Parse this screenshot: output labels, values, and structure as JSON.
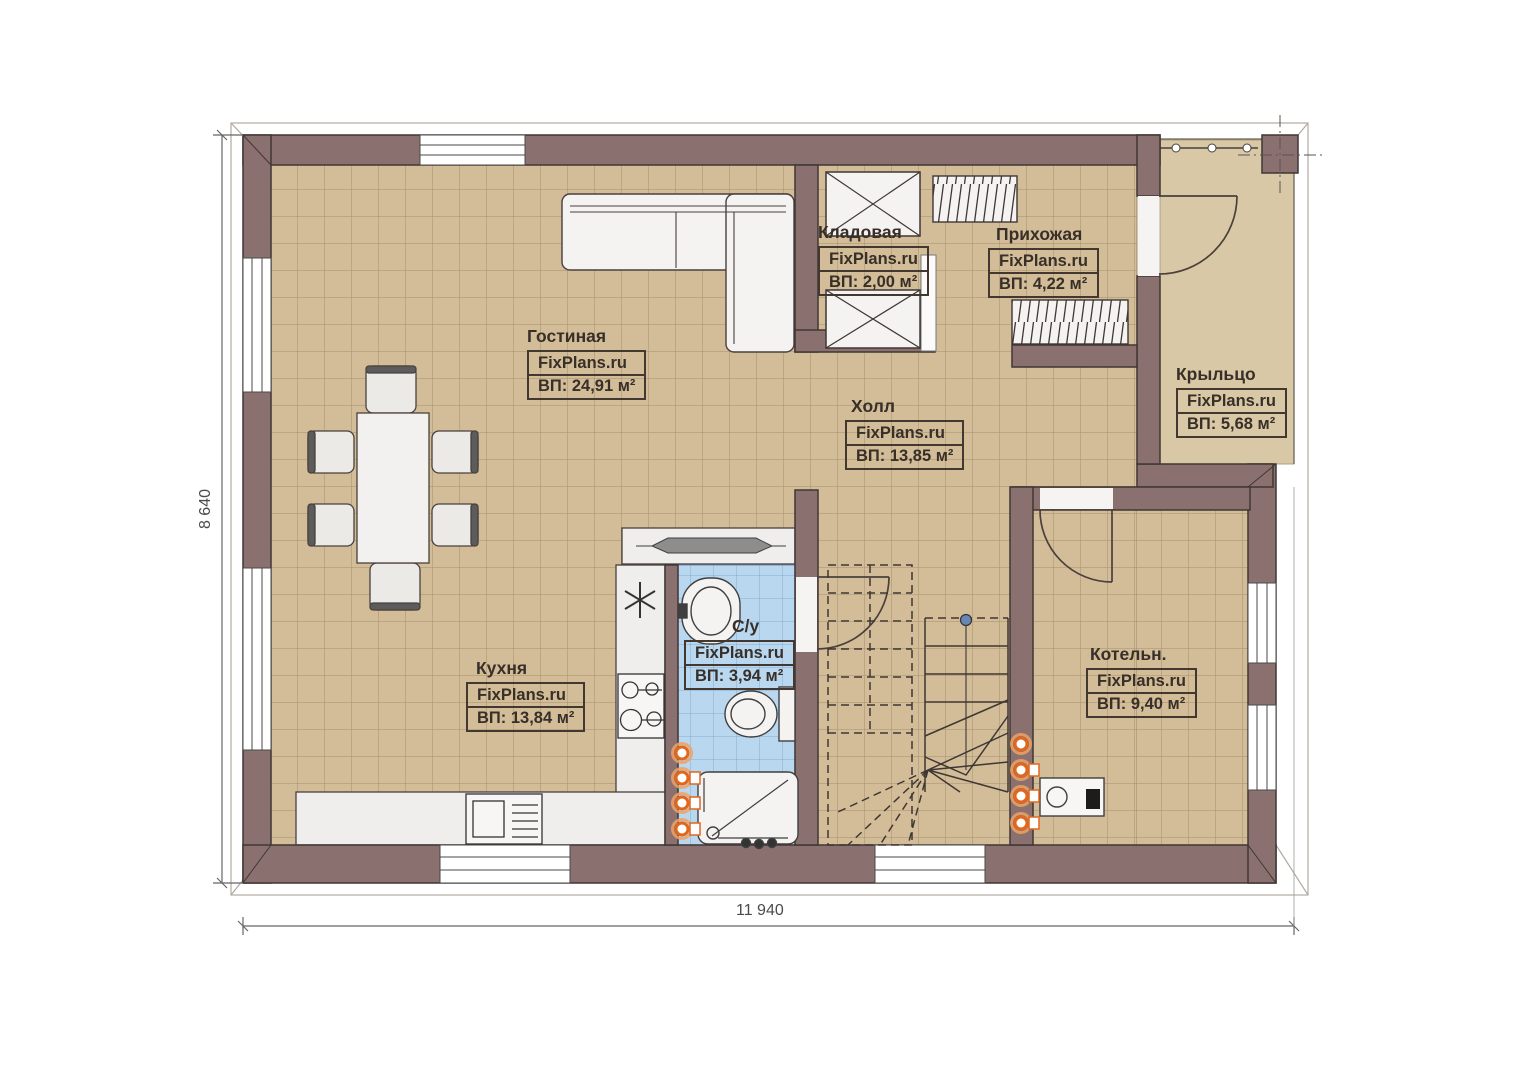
{
  "plan": {
    "title": "Floor plan first floor",
    "brand": "FixPlans.ru",
    "rooms": [
      {
        "name": "Гостиная",
        "brand": "FixPlans.ru",
        "area": "ВП: 24,91 м²"
      },
      {
        "name": "Кладовая",
        "brand": "FixPlans.ru",
        "area": "ВП: 2,00 м²"
      },
      {
        "name": "Прихожая",
        "brand": "FixPlans.ru",
        "area": "ВП: 4,22 м²"
      },
      {
        "name": "Крыльцо",
        "brand": "FixPlans.ru",
        "area": "ВП: 5,68 м²"
      },
      {
        "name": "Холл",
        "brand": "FixPlans.ru",
        "area": "ВП: 13,85 м²"
      },
      {
        "name": "Кухня",
        "brand": "FixPlans.ru",
        "area": "ВП: 13,84 м²"
      },
      {
        "name": "С/у",
        "brand": "FixPlans.ru",
        "area": "ВП: 3,94 м²"
      },
      {
        "name": "Котельн.",
        "brand": "FixPlans.ru",
        "area": "ВП: 9,40 м²"
      }
    ],
    "dimensions": {
      "width": "11 940",
      "height": "8 640"
    },
    "colors": {
      "wall": "#8a7170",
      "wall_outline": "#3f3734",
      "floor": "#d2bd98",
      "floor_grid": "#a6906c",
      "bath_floor": "#b9d8f0",
      "bath_grid": "#84abd0",
      "porch_floor": "#d8c8a6",
      "fixture": "#f2f1ef",
      "accent_orange": "#e2661c"
    }
  }
}
